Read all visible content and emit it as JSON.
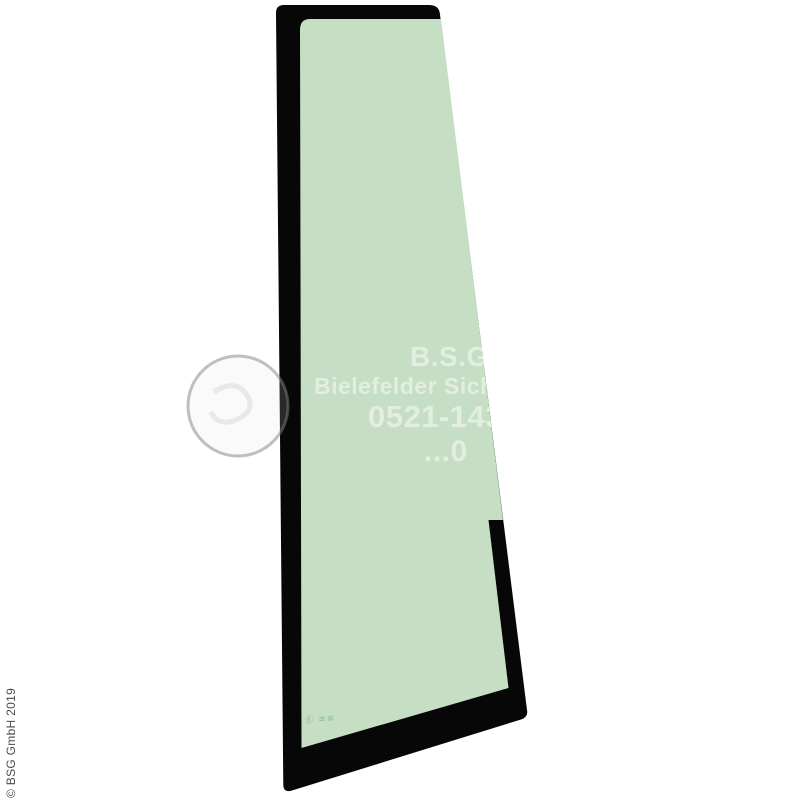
{
  "image": {
    "kind": "product-photo",
    "subject": "vehicle door vent window glass with black frame",
    "background": "#ffffff"
  },
  "colors": {
    "glass_green": "#c6dec4",
    "frame_black": "#070707",
    "watermark_text": "#e2efe0",
    "stamp_green": "#8ab99c",
    "copyright_gray": "#4b4b4b"
  },
  "watermark": {
    "line1": "B.S.G.",
    "line2": "Bielefelder Sicherh",
    "line3": "0521-14385",
    "line4": "...0"
  },
  "stamp": {
    "text": "Ⓔ ≋≋"
  },
  "copyright": {
    "text": "© BSG GmbH 2019"
  }
}
